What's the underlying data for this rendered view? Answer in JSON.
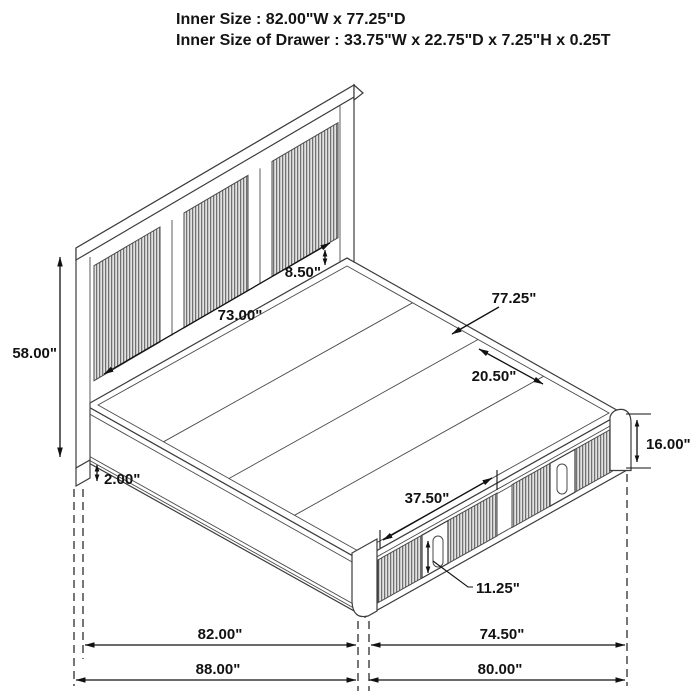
{
  "header": {
    "line1": "Inner Size : 82.00\"W x 77.25\"D",
    "line2": "Inner Size of Drawer : 33.75\"W x 22.75\"D x 7.25\"H x 0.25T"
  },
  "diagram": {
    "subject": "storage-bed-dimension-drawing",
    "dimensions": {
      "headboard_height": "58.00\"",
      "headboard_inner_width": "73.00\"",
      "headboard_rail_height": "8.50\"",
      "platform_inner_depth": "77.25\"",
      "slat_section_depth": "20.50\"",
      "footboard_height": "16.00\"",
      "leg_height": "2.00\"",
      "drawer_front_width": "37.50\"",
      "drawer_handle_height": "11.25\"",
      "side_rail_span": "82.00\"",
      "footboard_span": "74.50\"",
      "overall_depth": "88.00\"",
      "overall_width": "80.00\""
    }
  }
}
